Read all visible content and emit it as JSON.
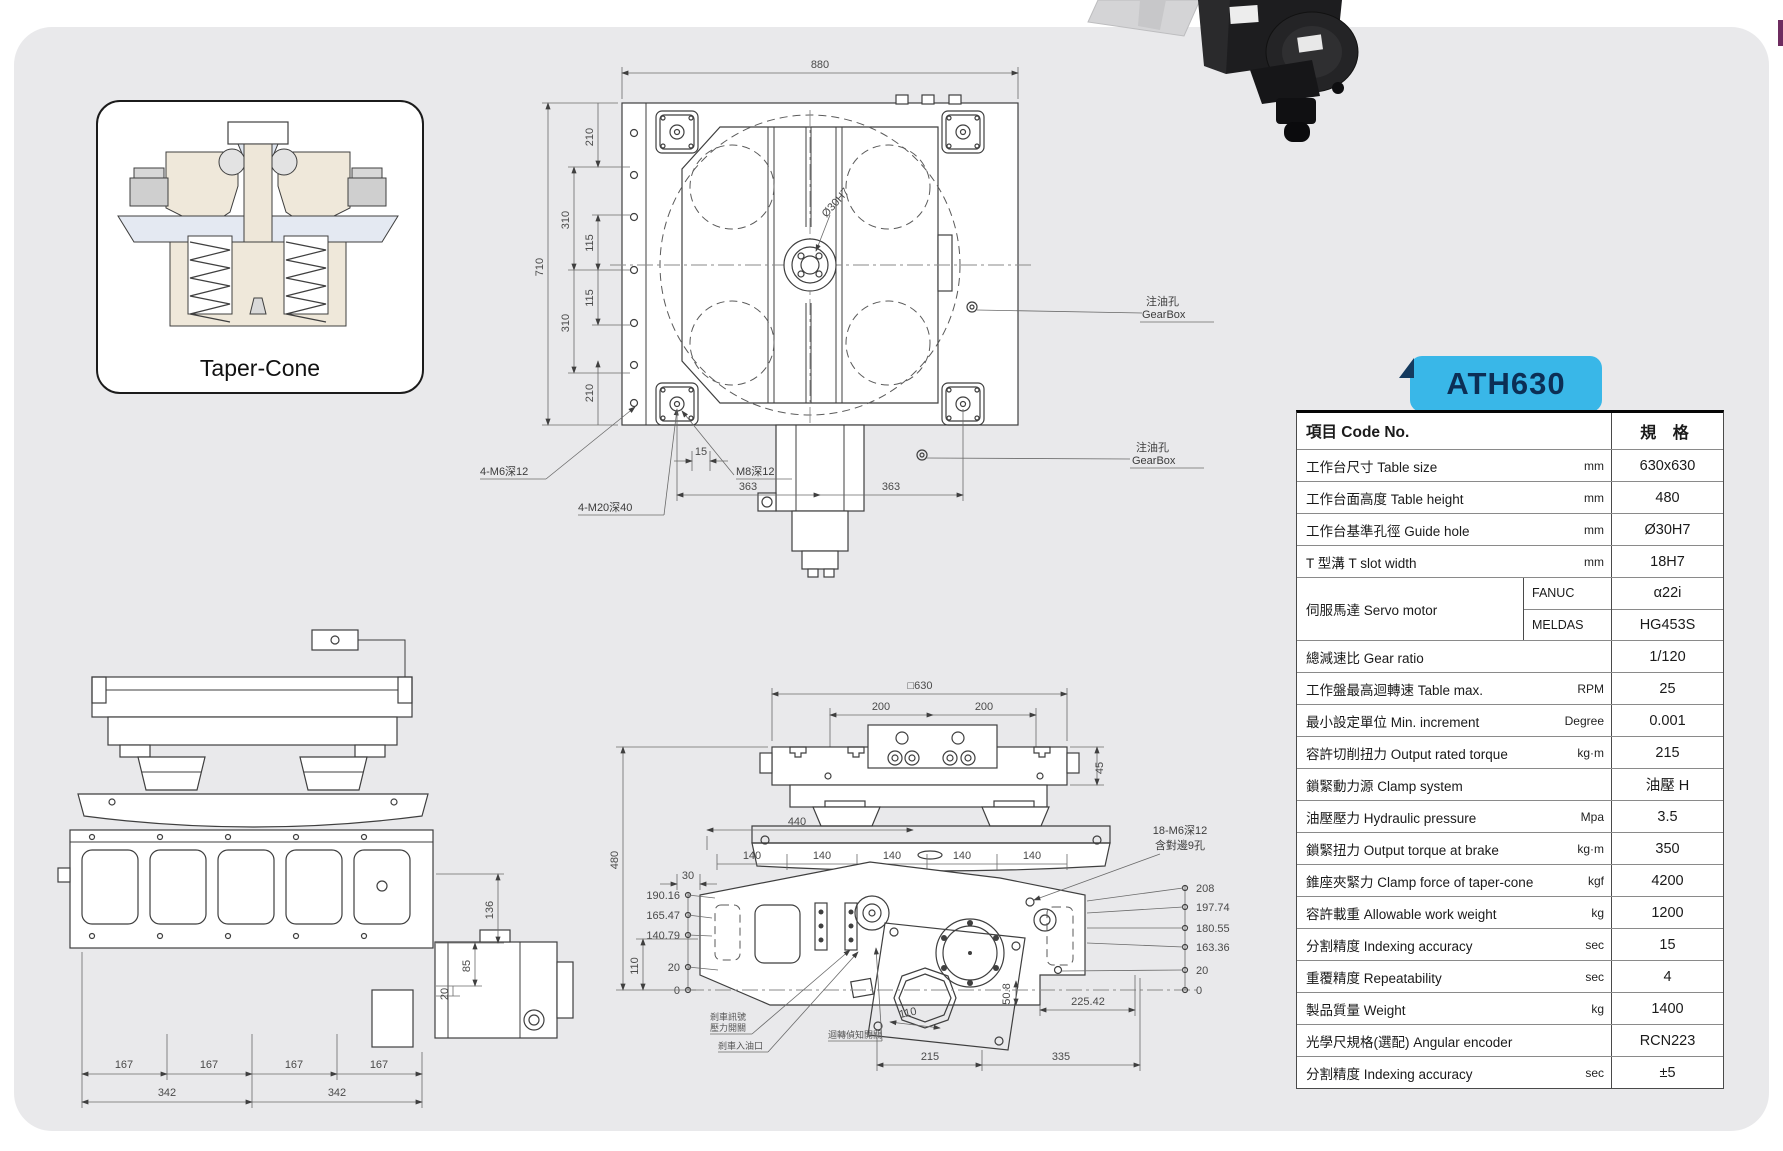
{
  "model_tab": {
    "label": "ATH630"
  },
  "taper_cone": {
    "caption": "Taper-Cone"
  },
  "spec_table": {
    "header": {
      "item": "項目 Code No.",
      "spec": "規 格"
    },
    "servo": {
      "label": "伺服馬達 Servo motor",
      "rows": [
        {
          "brand": "FANUC",
          "value": "α22i"
        },
        {
          "brand": "MELDAS",
          "value": "HG453S"
        }
      ]
    },
    "rows": [
      {
        "label": "工作台尺寸 Table size",
        "unit": "mm",
        "value": "630x630"
      },
      {
        "label": "工作台面高度 Table height",
        "unit": "mm",
        "value": "480"
      },
      {
        "label": "工作台基準孔徑 Guide hole",
        "unit": "mm",
        "value": "Ø30H7"
      },
      {
        "label": "T 型溝 T slot width",
        "unit": "mm",
        "value": "18H7"
      },
      {
        "label": "總減速比 Gear ratio",
        "unit": "",
        "value": "1/120"
      },
      {
        "label": "工作盤最高迴轉速 Table max.",
        "unit": "RPM",
        "value": "25"
      },
      {
        "label": "最小設定單位 Min. increment",
        "unit": "Degree",
        "value": "0.001"
      },
      {
        "label": "容許切削扭力 Output rated torque",
        "unit": "kg·m",
        "value": "215"
      },
      {
        "label": "鎖緊動力源 Clamp system",
        "unit": "",
        "value": "油壓 H"
      },
      {
        "label": "油壓壓力 Hydraulic pressure",
        "unit": "Mpa",
        "value": "3.5"
      },
      {
        "label": "鎖緊扭力 Output torque at brake",
        "unit": "kg·m",
        "value": "350"
      },
      {
        "label": "錐座夾緊力 Clamp force of taper-cone",
        "unit": "kgf",
        "value": "4200"
      },
      {
        "label": "容許載重 Allowable work weight",
        "unit": "kg",
        "value": "1200"
      },
      {
        "label": "分割精度 Indexing accuracy",
        "unit": "sec",
        "value": "15"
      },
      {
        "label": "重覆精度 Repeatability",
        "unit": "sec",
        "value": "4"
      },
      {
        "label": "製品質量 Weight",
        "unit": "kg",
        "value": "1400"
      },
      {
        "label": "光學尺規格(選配) Angular encoder",
        "unit": "",
        "value": "RCN223"
      },
      {
        "label": "分割精度 Indexing accuracy",
        "unit": "sec",
        "value": "±5"
      }
    ]
  },
  "top_view": {
    "dim_880": "880",
    "dim_710": "710",
    "chain_outer": [
      "310",
      "310"
    ],
    "chain_inner": [
      "210",
      "115",
      "115",
      "210"
    ],
    "label_4m6": "4-M6深12",
    "dim_15": "15",
    "label_m8": "M8深12",
    "label_4m20": "4-M20深40",
    "dim_363a": "363",
    "dim_363b": "363",
    "oil_1a": "注油孔",
    "oil_1b": "GearBox",
    "oil_2a": "注油孔",
    "oil_2b": "GearBox",
    "center_hole": "Ø30H7"
  },
  "side_view": {
    "dim_136": "136",
    "dim_85": "85",
    "dim_20": "20",
    "dims_167": [
      "167",
      "167",
      "167",
      "167"
    ],
    "dims_342": [
      "342",
      "342"
    ]
  },
  "front_view": {
    "dim_630": "□630",
    "dim_200a": "200",
    "dim_200b": "200",
    "dim_45": "45",
    "dim_440": "440",
    "dim_480": "480",
    "dims_140": [
      "140",
      "140",
      "140",
      "140",
      "140"
    ],
    "dim_30": "30",
    "left_heights": [
      "190.16",
      "165.47",
      "140.79",
      "20",
      "0"
    ],
    "dim_110_left": "110",
    "bolt_line1": "18-M6深12",
    "bolt_line2": "含對邊9孔",
    "right_heights": [
      "208",
      "197.74",
      "180.55",
      "163.36",
      "20",
      "0"
    ],
    "dim_508": "50.8",
    "dim_110b": "110",
    "dim_22542": "225.42",
    "dim_215": "215",
    "dim_335": "335",
    "leader_a1": "剎車訊號",
    "leader_a2": "壓力開關",
    "leader_b": "剎車入油口",
    "leader_c": "迴轉偵知開關"
  }
}
